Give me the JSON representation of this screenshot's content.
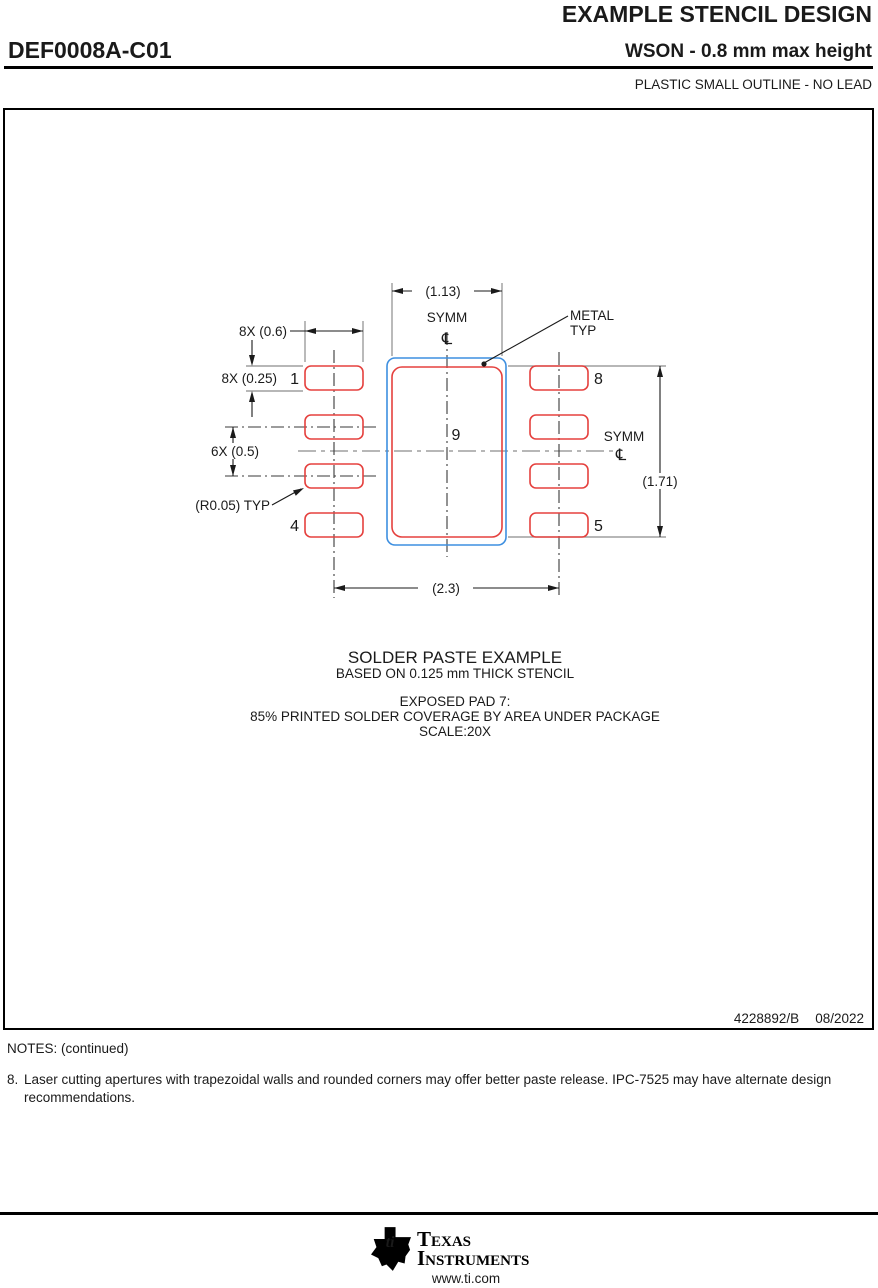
{
  "header": {
    "title": "EXAMPLE STENCIL DESIGN",
    "part_number": "DEF0008A-C01",
    "package_title": "WSON - 0.8 mm max height",
    "package_subtitle": "PLASTIC SMALL OUTLINE - NO LEAD"
  },
  "drawing": {
    "dim_top_width": "(1.13)",
    "dim_pad_width": "8X (0.6)",
    "dim_pad_height": "8X (0.25)",
    "dim_pitch": "6X (0.5)",
    "dim_radius": "(R0.05) TYP",
    "dim_span": "(2.3)",
    "dim_center_height": "(1.71)",
    "label_metal_line1": "METAL",
    "label_metal_line2": "TYP",
    "label_symm": "SYMM",
    "centerline_symbol": "℄",
    "pins": {
      "pin1": "1",
      "pin4": "4",
      "pin5": "5",
      "pin8": "8",
      "pin9": "9"
    },
    "caption": {
      "line1": "SOLDER PASTE EXAMPLE",
      "line2": "BASED ON 0.125 mm THICK STENCIL",
      "line3": "EXPOSED PAD 7:",
      "line4": "85% PRINTED SOLDER COVERAGE BY AREA UNDER PACKAGE",
      "line5": "SCALE:20X"
    },
    "doc_number": "4228892/B",
    "doc_date": "08/2022",
    "colors": {
      "pad_outline": "#e5413e",
      "metal_outline": "#3d8fe0",
      "line_black": "#1a1a1a",
      "line_gray": "#8c8c8c"
    }
  },
  "notes": {
    "heading": "NOTES: (continued)",
    "note8_number": "8.",
    "note8_text": "Laser cutting apertures with trapezoidal walls and rounded corners may offer better paste release. IPC-7525 may have alternate design recommendations."
  },
  "footer": {
    "brand_line1": "Texas",
    "brand_line2": "Instruments",
    "website": "www.ti.com"
  }
}
